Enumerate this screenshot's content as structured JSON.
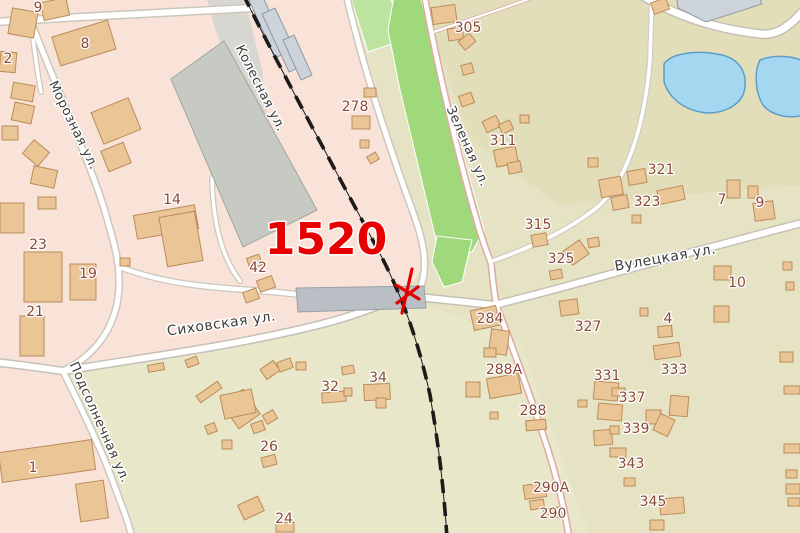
{
  "map": {
    "colors": {
      "pink_urban": "#f9e3d8",
      "olive_base": "#e6e3c4",
      "khaki_ne": "#e2deba",
      "light_s": "#e9e7c9",
      "park": "#a0d87c",
      "park_light": "#bce49e",
      "pond_fill": "#a4d7f0",
      "pond_stroke": "#5e9dc8",
      "building_fill": "#eac596",
      "building_stroke": "#bb8c5a",
      "grey_building_fill": "#c6cac3",
      "grey_building_stroke": "#a0a59b",
      "rail_building_fill": "#ccd3da",
      "rail_building_stroke": "#8e99a4",
      "platform_fill": "#babfc5",
      "platform_stroke": "#9aa0a6",
      "grey_corridor": "#d8d6d1",
      "road_fill": "#ffffff",
      "railway": "#1b1b1b",
      "annotation_red": "#e60000"
    },
    "regions": [
      {
        "name": "olive-base",
        "pts": "-4,-4 804,-4 804,537 -4,537",
        "fill": "#e6e3c4"
      },
      {
        "name": "khaki-northeast",
        "pts": "430,-4 804,-4 804,185 560,205 470,140 436,40",
        "fill": "#e2deba"
      },
      {
        "name": "light-south",
        "pts": "64,374 340,318 412,300 520,340 590,537 128,537",
        "fill": "#e9e7c9"
      },
      {
        "name": "pink-urban",
        "pts": "-4,-4 348,-4 380,100 415,215 424,262 408,293 330,320 230,344 120,360 63,371 90,430 114,480 133,537 -4,537",
        "fill": "#f9e3d8"
      },
      {
        "name": "railway-corridor",
        "pts": "206,-5 244,-5 262,70 270,145 258,178 236,84 214,26",
        "fill": "#d8d6d1"
      }
    ],
    "parks": [
      {
        "name": "park-strip-top",
        "pts": "350,-4 390,-4 404,40 368,52",
        "fill": "#bce49e"
      },
      {
        "name": "park-strip-main",
        "pts": "394,-4 420,-4 470,180 484,230 472,252 452,258 436,240 400,90 388,30",
        "fill": "#a0d87c"
      },
      {
        "name": "park-junction-triangle",
        "pts": "437,236 472,240 462,282 444,287 432,262",
        "fill": "#a0d87c"
      }
    ],
    "ponds": [
      {
        "name": "pond-west",
        "d": "M 664,64 C 672,52 700,50 722,55 C 742,60 748,76 744,92 C 740,106 720,116 700,112 C 680,108 668,95 664,82 Z"
      },
      {
        "name": "pond-east",
        "d": "M 760,60 C 775,54 795,56 804,62 L 804,115 C 790,119 772,116 763,105 C 755,92 754,72 760,60 Z"
      }
    ],
    "roads": [
      {
        "name": "road-thin-305",
        "d": "M 434,32 C 468,20 505,8 540,-5",
        "cw": 4,
        "fw": 2.2,
        "cc": "#e0b4ac"
      },
      {
        "name": "road-ne-minor",
        "d": "M 492,261 C 530,248 570,230 600,205 C 630,175 645,120 650,60 L 652,-6",
        "cw": 6,
        "fw": 3.5,
        "cc": "#d2cdc3"
      },
      {
        "name": "road-top-branch",
        "d": "M 31,21 C 34,48 37,70 41,92",
        "cw": 6,
        "fw": 3.5,
        "cc": "#ccc7bd"
      },
      {
        "name": "road-top",
        "d": "M -6,22 C 80,17 170,12 252,8",
        "cw": 9,
        "fw": 6,
        "cc": "#ccc7bd"
      },
      {
        "name": "road-moroznaya",
        "d": "M 30,19 C 55,85 85,150 103,205 C 115,245 122,268 118,298 C 112,338 86,360 63,371",
        "cw": 8,
        "fw": 5,
        "cc": "#ccc7bd"
      },
      {
        "name": "road-grey-bld-north",
        "d": "M 212,178 C 213,222 221,256 240,281",
        "cw": 6,
        "fw": 3.5,
        "cc": "#ccc7bd"
      },
      {
        "name": "road-grey-bld-loop",
        "d": "M 120,267 C 185,292 250,287 310,296 C 348,302 378,299 409,296",
        "cw": 7,
        "fw": 4.5,
        "cc": "#ccc7bd"
      },
      {
        "name": "road-podsolnechnaya",
        "d": "M 63,371 C 80,406 100,446 112,479 C 121,504 128,520 132,538",
        "cw": 8,
        "fw": 5,
        "cc": "#ccc7bd"
      },
      {
        "name": "road-sikhovska",
        "d": "M -6,362 C 30,366 48,369 63,371 C 140,358 235,346 322,324 C 372,311 390,299 409,296 L 494,305",
        "cw": 9,
        "fw": 6,
        "cc": "#c5c0b6"
      },
      {
        "name": "road-west-of-park",
        "d": "M 346,-6 C 365,75 392,155 414,215 C 424,243 428,266 421,286 C 418,293 413,295 409,296",
        "cw": 8,
        "fw": 5,
        "cc": "#ccc7bd"
      },
      {
        "name": "road-zelenaya-north",
        "d": "M 424,-6 C 438,70 458,155 476,218 C 483,243 488,255 491,263",
        "cw": 7.5,
        "fw": 4.5,
        "cc": "#dfaaa2"
      },
      {
        "name": "road-zelenaya-south",
        "d": "M 491,263 C 493,280 494,295 497,307 C 512,346 532,400 548,450 C 558,482 565,510 569,538",
        "cw": 7.5,
        "fw": 4.5,
        "cc": "#dfaaa2"
      },
      {
        "name": "road-vuletskaya",
        "d": "M 494,305 C 560,289 630,268 700,250 C 735,241 770,231 806,222",
        "cw": 9,
        "fw": 6,
        "cc": "#c5c0b6"
      },
      {
        "name": "road-top-right-v",
        "d": "M 640,-6 C 671,14 714,29 761,34 C 778,36 792,24 804,10",
        "cw": 10,
        "fw": 7,
        "cc": "#c5c0b6"
      }
    ],
    "railway": {
      "name": "railway-track",
      "d": "M 243,-6 C 278,65 330,160 378,250 C 402,295 418,340 430,395 C 438,440 444,490 447,538",
      "base_width": 1,
      "dash_width": 3.6,
      "dash": "14 9"
    },
    "poly_buildings": [
      {
        "name": "industrial-grey-building",
        "pts": "171,79 224,41 317,210 243,247",
        "cls": "grey"
      },
      {
        "name": "rail-platform-1",
        "pts": "249,0 262,-5 288,52 275,58",
        "cls": "rail"
      },
      {
        "name": "rail-platform-2",
        "pts": "262,14 275,8 302,66 289,72",
        "cls": "rail"
      },
      {
        "name": "rail-platform-3",
        "pts": "283,40 294,35 312,75 301,80",
        "cls": "rail"
      },
      {
        "name": "loading-platform",
        "pts": "296,288 424,286 426,308 298,312",
        "cls": "strip"
      },
      {
        "name": "top-right-grey-roof",
        "pts": "676,-6 758,-6 762,4 706,22 678,8",
        "cls": "rail"
      }
    ],
    "buildings": [
      [
        10,
        10,
        26,
        26,
        10
      ],
      [
        42,
        0,
        26,
        18,
        -12
      ],
      [
        55,
        28,
        58,
        30,
        -17
      ],
      [
        0,
        52,
        16,
        20,
        5
      ],
      [
        96,
        104,
        40,
        34,
        -22
      ],
      [
        104,
        146,
        24,
        22,
        -22
      ],
      [
        12,
        84,
        22,
        16,
        10
      ],
      [
        13,
        104,
        20,
        18,
        12
      ],
      [
        2,
        126,
        16,
        14,
        0
      ],
      [
        26,
        144,
        20,
        18,
        40
      ],
      [
        32,
        168,
        24,
        18,
        12
      ],
      [
        0,
        203,
        24,
        30,
        0
      ],
      [
        38,
        197,
        18,
        12,
        0
      ],
      [
        135,
        210,
        62,
        24,
        -10
      ],
      [
        163,
        214,
        36,
        50,
        -10
      ],
      [
        24,
        252,
        38,
        50,
        0
      ],
      [
        70,
        264,
        26,
        36,
        0
      ],
      [
        20,
        316,
        24,
        40,
        0
      ],
      [
        0,
        446,
        94,
        30,
        -8
      ],
      [
        78,
        482,
        28,
        38,
        -8
      ],
      [
        248,
        256,
        13,
        11,
        -20
      ],
      [
        258,
        278,
        16,
        12,
        -20
      ],
      [
        244,
        290,
        14,
        11,
        -20
      ],
      [
        120,
        258,
        10,
        8,
        0
      ],
      [
        364,
        88,
        12,
        9,
        0
      ],
      [
        352,
        116,
        18,
        13,
        0
      ],
      [
        360,
        140,
        9,
        8,
        0
      ],
      [
        368,
        154,
        10,
        8,
        -30
      ],
      [
        432,
        6,
        24,
        17,
        -8
      ],
      [
        448,
        28,
        15,
        12,
        -8
      ],
      [
        460,
        36,
        14,
        11,
        -40
      ],
      [
        462,
        64,
        11,
        10,
        -15
      ],
      [
        460,
        94,
        13,
        11,
        -20
      ],
      [
        484,
        118,
        15,
        12,
        -25
      ],
      [
        500,
        122,
        12,
        10,
        -25
      ],
      [
        495,
        148,
        22,
        17,
        -12
      ],
      [
        508,
        162,
        13,
        11,
        -12
      ],
      [
        520,
        115,
        9,
        8,
        0
      ],
      [
        600,
        178,
        22,
        18,
        -10
      ],
      [
        628,
        170,
        18,
        14,
        -10
      ],
      [
        658,
        188,
        26,
        14,
        -12
      ],
      [
        612,
        196,
        16,
        13,
        -10
      ],
      [
        632,
        215,
        9,
        8,
        0
      ],
      [
        588,
        158,
        10,
        9,
        0
      ],
      [
        727,
        180,
        13,
        18,
        0
      ],
      [
        748,
        186,
        10,
        12,
        0
      ],
      [
        754,
        202,
        20,
        18,
        -8
      ],
      [
        714,
        266,
        17,
        14,
        0
      ],
      [
        714,
        306,
        15,
        16,
        0
      ],
      [
        783,
        262,
        9,
        8,
        0
      ],
      [
        786,
        282,
        8,
        8,
        0
      ],
      [
        532,
        234,
        15,
        12,
        -10
      ],
      [
        566,
        244,
        20,
        17,
        -35
      ],
      [
        588,
        238,
        11,
        9,
        -10
      ],
      [
        550,
        270,
        12,
        9,
        -10
      ],
      [
        560,
        300,
        18,
        15,
        -8
      ],
      [
        640,
        308,
        8,
        8,
        0
      ],
      [
        658,
        326,
        14,
        11,
        -5
      ],
      [
        654,
        344,
        26,
        14,
        -8
      ],
      [
        472,
        308,
        26,
        20,
        -12
      ],
      [
        490,
        330,
        18,
        24,
        8
      ],
      [
        484,
        348,
        12,
        9,
        0
      ],
      [
        466,
        382,
        14,
        15,
        0
      ],
      [
        488,
        376,
        32,
        20,
        -10
      ],
      [
        526,
        420,
        20,
        10,
        -5
      ],
      [
        490,
        412,
        8,
        7,
        0
      ],
      [
        524,
        484,
        22,
        14,
        -8
      ],
      [
        530,
        500,
        14,
        9,
        -8
      ],
      [
        544,
        508,
        16,
        10,
        -8
      ],
      [
        594,
        382,
        24,
        18,
        5
      ],
      [
        598,
        404,
        24,
        16,
        5
      ],
      [
        578,
        400,
        9,
        7,
        0
      ],
      [
        612,
        388,
        13,
        8,
        0
      ],
      [
        670,
        396,
        18,
        20,
        5
      ],
      [
        646,
        410,
        15,
        14,
        0
      ],
      [
        656,
        416,
        16,
        18,
        25
      ],
      [
        594,
        430,
        18,
        15,
        -5
      ],
      [
        610,
        426,
        9,
        8,
        0
      ],
      [
        610,
        448,
        16,
        9,
        0
      ],
      [
        624,
        478,
        11,
        8,
        0
      ],
      [
        660,
        498,
        24,
        16,
        -5
      ],
      [
        650,
        520,
        14,
        10,
        0
      ],
      [
        780,
        352,
        13,
        10,
        0
      ],
      [
        784,
        386,
        16,
        8,
        0
      ],
      [
        784,
        444,
        16,
        9,
        0
      ],
      [
        786,
        470,
        11,
        8,
        0
      ],
      [
        786,
        484,
        14,
        10,
        0
      ],
      [
        788,
        498,
        12,
        8,
        0
      ],
      [
        322,
        392,
        24,
        10,
        -5
      ],
      [
        344,
        388,
        8,
        8,
        0
      ],
      [
        364,
        384,
        26,
        16,
        -3
      ],
      [
        376,
        398,
        10,
        10,
        0
      ],
      [
        342,
        366,
        12,
        8,
        -10
      ],
      [
        262,
        364,
        16,
        12,
        -35
      ],
      [
        278,
        360,
        14,
        10,
        -20
      ],
      [
        296,
        362,
        10,
        8,
        0
      ],
      [
        228,
        394,
        26,
        30,
        -35
      ],
      [
        264,
        412,
        12,
        10,
        -30
      ],
      [
        252,
        422,
        12,
        10,
        -20
      ],
      [
        262,
        456,
        14,
        10,
        -15
      ],
      [
        240,
        500,
        22,
        16,
        -25
      ],
      [
        276,
        522,
        18,
        10,
        0
      ],
      [
        196,
        388,
        26,
        8,
        -35
      ],
      [
        222,
        392,
        32,
        24,
        -12
      ],
      [
        206,
        424,
        10,
        9,
        -20
      ],
      [
        222,
        440,
        10,
        9,
        0
      ],
      [
        148,
        364,
        16,
        7,
        -10
      ],
      [
        186,
        358,
        12,
        8,
        -20
      ],
      [
        652,
        0,
        16,
        12,
        -20
      ]
    ],
    "street_labels": [
      {
        "text": "Морозная ул.",
        "x": 70,
        "y": 127,
        "rot": 64,
        "size": 13
      },
      {
        "text": "Колесная ул.",
        "x": 257,
        "y": 90,
        "rot": 63,
        "size": 13
      },
      {
        "text": "Зеленая ул.",
        "x": 464,
        "y": 148,
        "rot": 66,
        "size": 13
      },
      {
        "text": "Вулецкая ул.",
        "x": 666,
        "y": 262,
        "rot": -10,
        "size": 14
      },
      {
        "text": "Сиховская ул.",
        "x": 222,
        "y": 328,
        "rot": -8,
        "size": 14
      },
      {
        "text": "Подсолнечная ул.",
        "x": 96,
        "y": 424,
        "rot": 66,
        "size": 13
      }
    ],
    "number_labels": [
      {
        "text": "9",
        "x": 38,
        "y": 12
      },
      {
        "text": "8",
        "x": 85,
        "y": 48
      },
      {
        "text": "2",
        "x": 8,
        "y": 63
      },
      {
        "text": "14",
        "x": 172,
        "y": 204
      },
      {
        "text": "23",
        "x": 38,
        "y": 249
      },
      {
        "text": "19",
        "x": 88,
        "y": 278
      },
      {
        "text": "21",
        "x": 35,
        "y": 316
      },
      {
        "text": "42",
        "x": 258,
        "y": 272
      },
      {
        "text": "1",
        "x": 33,
        "y": 472
      },
      {
        "text": "278",
        "x": 355,
        "y": 111
      },
      {
        "text": "305",
        "x": 468,
        "y": 32
      },
      {
        "text": "311",
        "x": 503,
        "y": 145
      },
      {
        "text": "321",
        "x": 661,
        "y": 174
      },
      {
        "text": "323",
        "x": 647,
        "y": 206
      },
      {
        "text": "315",
        "x": 538,
        "y": 229
      },
      {
        "text": "325",
        "x": 561,
        "y": 263
      },
      {
        "text": "7",
        "x": 722,
        "y": 204
      },
      {
        "text": "9",
        "x": 760,
        "y": 207
      },
      {
        "text": "10",
        "x": 737,
        "y": 287
      },
      {
        "text": "4",
        "x": 668,
        "y": 323
      },
      {
        "text": "327",
        "x": 588,
        "y": 331
      },
      {
        "text": "284",
        "x": 490,
        "y": 323
      },
      {
        "text": "288А",
        "x": 504,
        "y": 374
      },
      {
        "text": "288",
        "x": 533,
        "y": 415
      },
      {
        "text": "290А",
        "x": 551,
        "y": 492
      },
      {
        "text": "290",
        "x": 553,
        "y": 518
      },
      {
        "text": "331",
        "x": 607,
        "y": 380
      },
      {
        "text": "337",
        "x": 632,
        "y": 402
      },
      {
        "text": "333",
        "x": 674,
        "y": 374
      },
      {
        "text": "339",
        "x": 636,
        "y": 433
      },
      {
        "text": "343",
        "x": 631,
        "y": 468
      },
      {
        "text": "345",
        "x": 653,
        "y": 506
      },
      {
        "text": "32",
        "x": 330,
        "y": 391
      },
      {
        "text": "34",
        "x": 378,
        "y": 382
      },
      {
        "text": "26",
        "x": 269,
        "y": 451
      },
      {
        "text": "24",
        "x": 284,
        "y": 523
      }
    ],
    "annotation": {
      "text": "1520",
      "x": 326,
      "y": 254,
      "size": 44,
      "color": "#e60000"
    },
    "crossing_icon": {
      "color": "#e60000",
      "paths": [
        "M 412,269 L 402,313",
        "M 396,285 L 419,299",
        "M 418,287 L 397,303"
      ]
    }
  }
}
